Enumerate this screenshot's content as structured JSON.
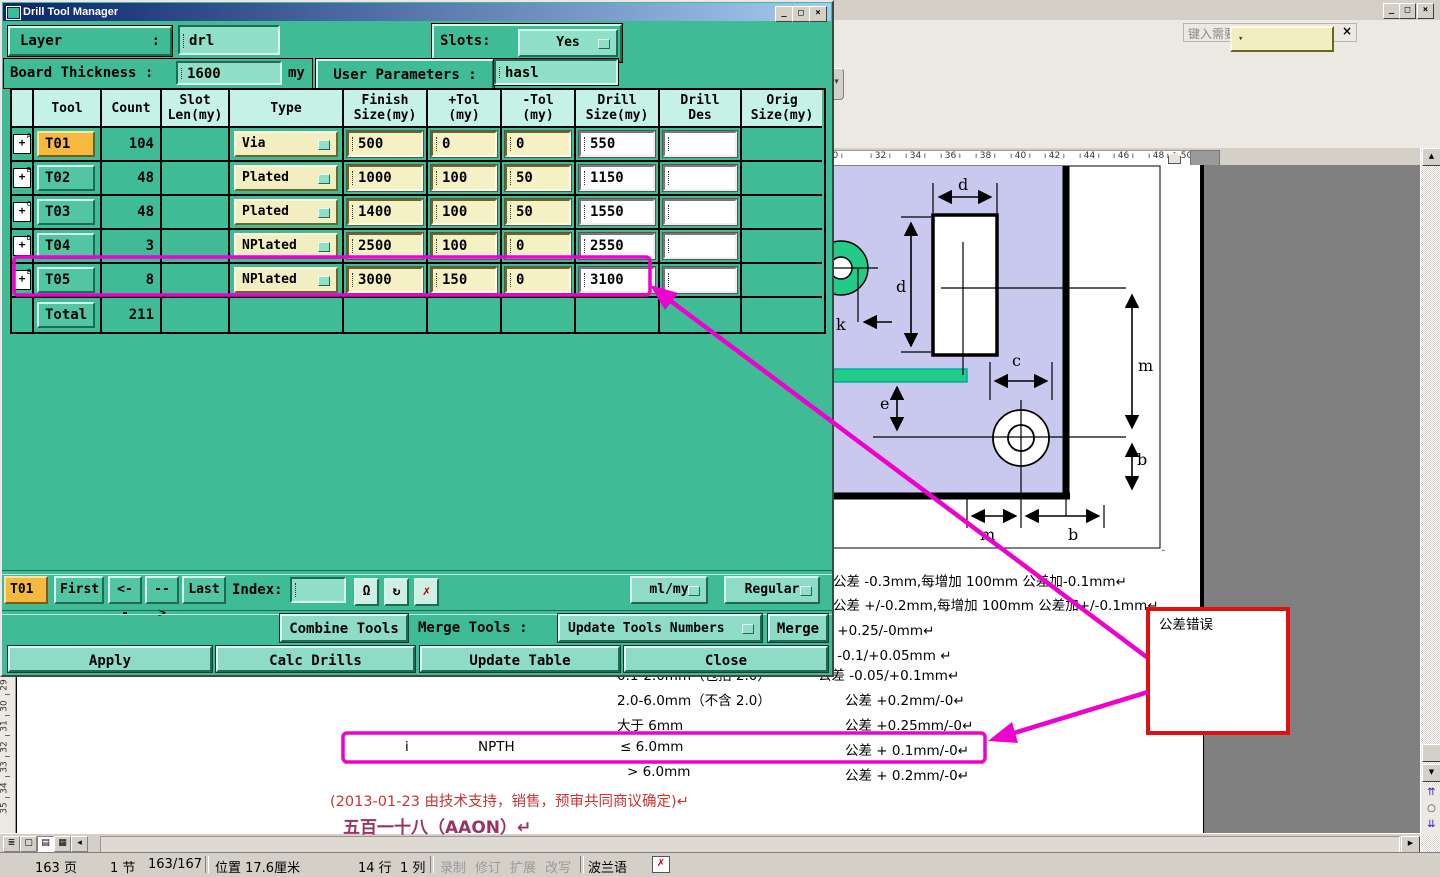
{
  "colors": {
    "dialog_bg": "#3fbc96",
    "header_bg": "#c6f1e7",
    "field_yellow": "#f5f1c5",
    "field_green": "#8fe0c7",
    "tool_active": "#f5b93f",
    "magenta": "#ee00ce",
    "annotation_red": "#e01010",
    "workspace_gray": "#808080",
    "chrome_gray": "#d4d0c8",
    "title_blue": "#0a246a",
    "pcb_lavender": "#c9c9f0",
    "pcb_green": "#22cc88"
  },
  "dialog": {
    "title": "Drill Tool Manager",
    "win": {
      "minimize": "_",
      "maximize": "□",
      "close": "×"
    },
    "fields": {
      "layer_label": "Layer",
      "layer_colon": ":",
      "layer_value": "drl",
      "slots_label": "Slots:",
      "slots_value": "Yes",
      "thickness_label": "Board Thickness :",
      "thickness_value": "1600",
      "thickness_unit": "my",
      "user_params_label": "User Parameters :",
      "user_params_value": "hasl"
    },
    "table": {
      "plus_icon": "+",
      "headers": [
        {
          "l1": "",
          "l2": ""
        },
        {
          "l1": "Tool",
          "l2": ""
        },
        {
          "l1": "Count",
          "l2": ""
        },
        {
          "l1": "Slot",
          "l2": "Len(my)"
        },
        {
          "l1": "Type",
          "l2": ""
        },
        {
          "l1": "Finish",
          "l2": "Size(my)"
        },
        {
          "l1": "+Tol",
          "l2": "(my)"
        },
        {
          "l1": "-Tol",
          "l2": "(my)"
        },
        {
          "l1": "Drill",
          "l2": "Size(my)"
        },
        {
          "l1": "Drill",
          "l2": "Des"
        },
        {
          "l1": "Orig",
          "l2": "Size(my)"
        }
      ],
      "rows": [
        {
          "badge": "A",
          "tool": "T01",
          "count": "104",
          "type": "Via",
          "finish": "500",
          "plus_tol": "0",
          "minus_tol": "0",
          "drill": "550",
          "des": ""
        },
        {
          "badge": "B",
          "tool": "T02",
          "count": "48",
          "type": "Plated",
          "finish": "1000",
          "plus_tol": "100",
          "minus_tol": "50",
          "drill": "1150",
          "des": ""
        },
        {
          "badge": "C",
          "tool": "T03",
          "count": "48",
          "type": "Plated",
          "finish": "1400",
          "plus_tol": "100",
          "minus_tol": "50",
          "drill": "1550",
          "des": ""
        },
        {
          "badge": "D",
          "tool": "T04",
          "count": "3",
          "type": "NPlated",
          "finish": "2500",
          "plus_tol": "100",
          "minus_tol": "0",
          "drill": "2550",
          "des": ""
        },
        {
          "badge": "E",
          "tool": "T05",
          "count": "8",
          "type": "NPlated",
          "finish": "3000",
          "plus_tol": "150",
          "minus_tol": "0",
          "drill": "3100",
          "des": ""
        }
      ],
      "total_label": "Total",
      "total_count": "211"
    },
    "nav": {
      "current_tool": "T01",
      "first": "First",
      "prev": "<--",
      "next": "-->",
      "last": "Last",
      "index_label": "Index:",
      "index_value": "",
      "bulb_icon": "Ω",
      "refresh_icon": "↻",
      "delete_icon": "✗",
      "units_value": "ml/my",
      "mode_value": "Regular"
    },
    "actions": {
      "combine": "Combine Tools",
      "merge_tools_label": "Merge Tools :",
      "merge_mode": "Update Tools Numbers",
      "merge": "Merge",
      "apply": "Apply",
      "calc_drills": "Calc Drills",
      "update_table": "Update Table",
      "close": "Close"
    }
  },
  "word": {
    "help_prompt": "键入需要帮助的问题",
    "help_dd": "▾",
    "help_close": "×",
    "win": {
      "minimize": "_",
      "restore": "□",
      "close": "×"
    },
    "chevron": "▾",
    "ruler": {
      "numbers": [
        "30",
        "32",
        "34",
        "36",
        "38",
        "40",
        "42",
        "44",
        "46",
        "48",
        "50"
      ]
    },
    "vruler": {
      "numbers": [
        "29",
        "30",
        "31",
        "32",
        "33",
        "34",
        "35"
      ]
    },
    "view_buttons": [
      "≣",
      "▢",
      "▤",
      "▦",
      "◂"
    ],
    "scroll": {
      "up": "▲",
      "down": "▼",
      "right": "▶",
      "browse_up": "⇈",
      "browse_dot": "○",
      "browse_down": "⇊"
    },
    "status": {
      "page": "163 页",
      "section": "1 节",
      "of": "163/167",
      "position": "位置 17.6厘米",
      "line": "14 行",
      "column": "1 列",
      "record": "录制",
      "revise": "修订",
      "extend": "扩展",
      "overwrite": "改写",
      "language": "波兰语",
      "spell": "✗"
    }
  },
  "document": {
    "diagram_labels": {
      "d_top": "d",
      "d_left": "d",
      "k": "k",
      "c": "c",
      "m_right": "m",
      "e": "e",
      "b_right": "b",
      "m_bottom": "m",
      "b_bottom": "b",
      "pilcrow": "↵"
    },
    "lines": [
      "公差 -0.3mm,每增加 100mm 公差加-0.1mm↵",
      "公差 +/-0.2mm,每增加 100mm 公差加+/-0.1mm↵",
      "公差 +0.25/-0mm↵",
      "公差 -0.1/+0.05mm ↵"
    ],
    "tol_rows": [
      {
        "c1": "",
        "c2": "",
        "c3": "0.1-2.0mm（包括 2.0）",
        "c4": "公差  -0.05/+0.1mm↵"
      },
      {
        "c1": "",
        "c2": "",
        "c3": "2.0-6.0mm（不含 2.0）",
        "c4": "公差 +0.2mm/-0↵"
      },
      {
        "c1": "",
        "c2": "",
        "c3": "大于 6mm",
        "c4": "公差 +0.25mm/-0↵"
      },
      {
        "c1": "i",
        "c2": "NPTH",
        "c3": "≤ 6.0mm",
        "c4": "公差 + 0.1mm/-0↵"
      },
      {
        "c1": "",
        "c2": "",
        "c3": "> 6.0mm",
        "c4": "公差 + 0.2mm/-0↵"
      }
    ],
    "note": "(2013-01-23 由技术支持，销售，预审共同商议确定)↵",
    "heading": "五百一十八（AAON）↵",
    "annotation_label": "公差错误"
  }
}
